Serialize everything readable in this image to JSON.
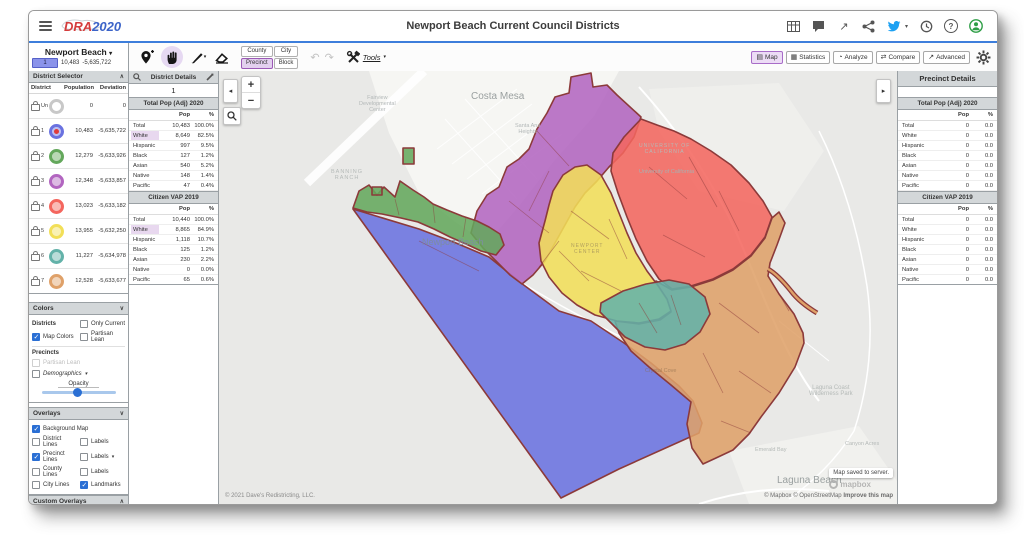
{
  "topbar": {
    "title": "Newport Beach Current Council Districts",
    "logo_dra": "DRA",
    "logo_year": "2020"
  },
  "toolbar": {
    "map_name": "Newport Beach",
    "chip": "1",
    "chip_pop": "10,483",
    "chip_dev": "-5,635,722",
    "geo": {
      "county": "County",
      "city": "City",
      "precinct": "Precinct",
      "block": "Block"
    },
    "undo": "↶",
    "redo": "↷",
    "tools_label": "Tools",
    "views": [
      {
        "label": "Map",
        "icon": "▤"
      },
      {
        "label": "Statistics",
        "icon": "▦"
      },
      {
        "label": "Analyze",
        "icon": "◔"
      },
      {
        "label": "Compare",
        "icon": "⇄"
      },
      {
        "label": "Advanced",
        "icon": "↗"
      }
    ]
  },
  "district_selector": {
    "title": "District Selector",
    "col_district": "District",
    "col_population": "Population",
    "col_deviation": "Deviation",
    "rows": [
      {
        "id": "Un",
        "color": "#c8c8c8",
        "fill": "#ffffff",
        "population": "0",
        "deviation": "0"
      },
      {
        "id": "1",
        "color": "#6a72e0",
        "fill": "#6a72e0",
        "population": "10,483",
        "deviation": "-5,635,722"
      },
      {
        "id": "2",
        "color": "#64a85c",
        "fill": "#64a85c",
        "population": "12,279",
        "deviation": "-5,633,926"
      },
      {
        "id": "3",
        "color": "#b265c0",
        "fill": "#b265c0",
        "population": "12,348",
        "deviation": "-5,633,857"
      },
      {
        "id": "4",
        "color": "#f4665e",
        "fill": "#f4665e",
        "population": "13,023",
        "deviation": "-5,633,182"
      },
      {
        "id": "5",
        "color": "#f2df58",
        "fill": "#f2df58",
        "population": "13,955",
        "deviation": "-5,632,250"
      },
      {
        "id": "6",
        "color": "#63b2a9",
        "fill": "#63b2a9",
        "population": "11,227",
        "deviation": "-5,634,978"
      },
      {
        "id": "7",
        "color": "#dfa169",
        "fill": "#dfa169",
        "population": "12,528",
        "deviation": "-5,633,677"
      }
    ]
  },
  "district_details": {
    "title": "District Details",
    "value": "1",
    "sections": [
      {
        "title": "Total Pop (Adj) 2020",
        "col_pop": "Pop",
        "col_pct": "%",
        "rows": [
          [
            "Total",
            "10,483",
            "100.0%"
          ],
          [
            "White",
            "8,649",
            "82.5%"
          ],
          [
            "Hispanic",
            "997",
            "9.5%"
          ],
          [
            "Black",
            "127",
            "1.2%"
          ],
          [
            "Asian",
            "540",
            "5.2%"
          ],
          [
            "Native",
            "148",
            "1.4%"
          ],
          [
            "Pacific",
            "47",
            "0.4%"
          ]
        ]
      },
      {
        "title": "Citizen VAP 2019",
        "col_pop": "Pop",
        "col_pct": "%",
        "rows": [
          [
            "Total",
            "10,440",
            "100.0%"
          ],
          [
            "White",
            "8,865",
            "84.9%"
          ],
          [
            "Hispanic",
            "1,118",
            "10.7%"
          ],
          [
            "Black",
            "125",
            "1.2%"
          ],
          [
            "Asian",
            "230",
            "2.2%"
          ],
          [
            "Native",
            "0",
            "0.0%"
          ],
          [
            "Pacific",
            "65",
            "0.6%"
          ]
        ]
      }
    ]
  },
  "colors_panel": {
    "title": "Colors",
    "districts_label": "Districts",
    "only_current": "Only Current",
    "map_colors": "Map Colors",
    "partisan_lean": "Partisan Lean",
    "precincts_label": "Precincts",
    "partisan_lean_precincts": "Partisan Lean",
    "demographics": "Demographics",
    "opacity_label": "Opacity"
  },
  "overlays_panel": {
    "title": "Overlays",
    "background_map": "Background Map",
    "district_lines": "District Lines",
    "labels_district": "Labels",
    "precinct_lines": "Precinct Lines",
    "labels_precinct": "Labels",
    "county_lines": "County Lines",
    "labels_county": "Labels",
    "city_lines": "City Lines",
    "landmarks": "Landmarks"
  },
  "custom_overlays": {
    "title": "Custom Overlays"
  },
  "precinct_details": {
    "title": "Precinct Details",
    "sections": [
      {
        "title": "Total Pop (Adj) 2020",
        "col_pop": "Pop",
        "col_pct": "%",
        "rows": [
          [
            "Total",
            "0",
            "0.0"
          ],
          [
            "White",
            "0",
            "0.0"
          ],
          [
            "Hispanic",
            "0",
            "0.0"
          ],
          [
            "Black",
            "0",
            "0.0"
          ],
          [
            "Asian",
            "0",
            "0.0"
          ],
          [
            "Native",
            "0",
            "0.0"
          ],
          [
            "Pacific",
            "0",
            "0.0"
          ]
        ]
      },
      {
        "title": "Citizen VAP 2019",
        "col_pop": "Pop",
        "col_pct": "%",
        "rows": [
          [
            "Total",
            "0",
            "0.0"
          ],
          [
            "White",
            "0",
            "0.0"
          ],
          [
            "Hispanic",
            "0",
            "0.0"
          ],
          [
            "Black",
            "0",
            "0.0"
          ],
          [
            "Asian",
            "0",
            "0.0"
          ],
          [
            "Native",
            "0",
            "0.0"
          ],
          [
            "Pacific",
            "0",
            "0.0"
          ]
        ]
      }
    ]
  },
  "map": {
    "zoom_in": "+",
    "zoom_out": "−",
    "collapse_left": "◂",
    "collapse_right": "▸",
    "saved_notice": "Map saved to server.",
    "attribution_left": "© 2021 Dave's Redistricting, LLC.",
    "mapbox_logo": "mapbox",
    "attribution_right": "© Mapbox © OpenStreetMap ",
    "improve_link": "Improve this map",
    "labels": {
      "costa_mesa": "Costa Mesa",
      "fairview": "Fairview\nDevelopmental\nCenter",
      "santa_ana": "Santa Ana\nHeights",
      "banning": "BANNING\nRANCH",
      "uc_small": "UNIVERSITY OF\nCALIFORNIA",
      "uc": "University of California",
      "newport_beach": "Newport Beach",
      "newport_center": "NEWPORT\nCENTER",
      "crystal_cove": "Crystal Cove",
      "wilderness": "Laguna Coast\nWilderness Park",
      "emerald": "Emerald Bay",
      "canyon": "Canyon Acres",
      "laguna_beach": "Laguna Beach"
    }
  },
  "districts": {
    "colors": {
      "d1": "#6a72e0",
      "d2": "#64a85c",
      "d3": "#b265c0",
      "d4": "#f4665e",
      "d5": "#f2df58",
      "d6": "#63b2a9",
      "d7": "#dfa169",
      "border": "#8c3a3a"
    }
  }
}
